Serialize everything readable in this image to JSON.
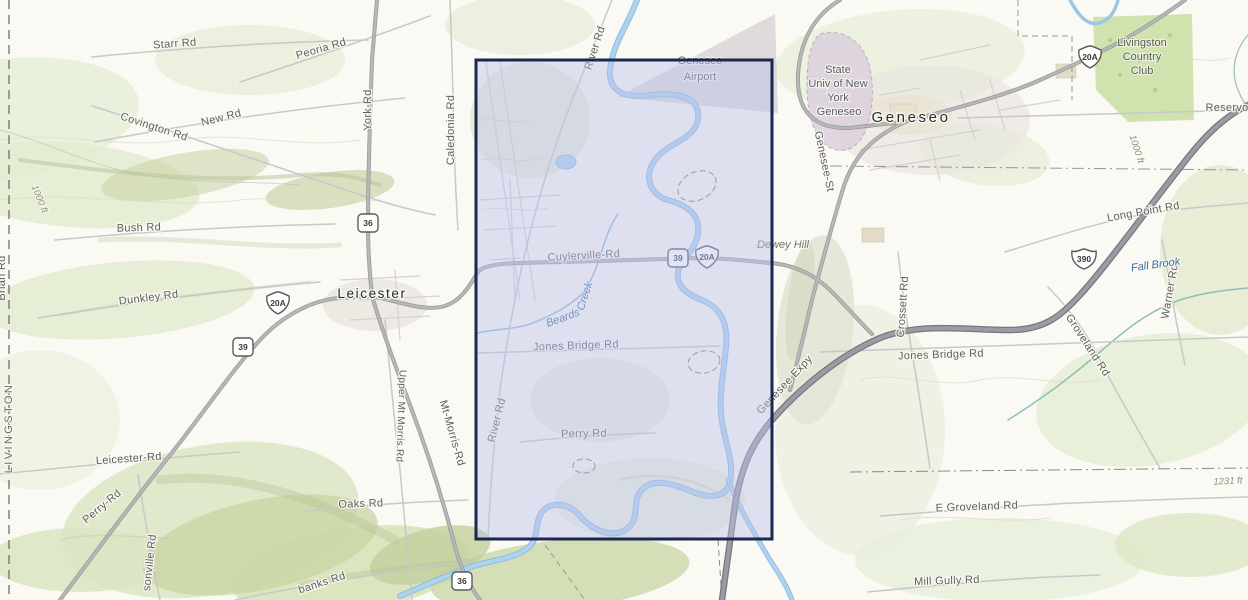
{
  "map": {
    "selection": {
      "x": 476,
      "y": 60,
      "width": 296,
      "height": 479
    },
    "colors": {
      "selection_fill": "#bdc0ec",
      "selection_border": "#1a2850",
      "water": "#aed3ee",
      "water_casing": "#8fbcdf",
      "road_major": "#b5b5b5",
      "road_casing": "#999999",
      "road_minor": "#c8c8c8",
      "expressway": "#9b9ba3",
      "expressway_casing": "#77777f",
      "terrain_green": "#e7eed9",
      "golf_green": "#cde2ab",
      "campus_purple": "#dccfdd",
      "airport_gray": "#c9c2c9",
      "water_label": "#3a6ca6",
      "road_label": "#5f5f5f"
    },
    "road_labels": [
      {
        "text": "Starr Rd"
      },
      {
        "text": "Peoria Rd"
      },
      {
        "text": "New Rd"
      },
      {
        "text": "Covington Rd"
      },
      {
        "text": "York-Rd"
      },
      {
        "text": "Caledonia Rd"
      },
      {
        "text": "Bush Rd"
      },
      {
        "text": "Dunkley Rd"
      },
      {
        "text": "Brian Rd"
      },
      {
        "text": "Leicester-Rd"
      },
      {
        "text": "Perry-Rd"
      },
      {
        "text": "sonville Rd"
      },
      {
        "text": "Oaks Rd"
      },
      {
        "text": "banks Rd"
      },
      {
        "text": "Upper Mt Morris Rd"
      },
      {
        "text": "Mt-Morris-Rd"
      },
      {
        "text": "River Rd"
      },
      {
        "text": "Cuylerville-Rd"
      },
      {
        "text": "Jones Bridge Rd"
      },
      {
        "text": "River Rd"
      },
      {
        "text": "Perry Rd"
      },
      {
        "text": "Genesee-St"
      },
      {
        "text": "Genesee Expy"
      },
      {
        "text": "Crossett Rd"
      },
      {
        "text": "Jones Bridge Rd"
      },
      {
        "text": "Groveland Rd"
      },
      {
        "text": "Long Point Rd"
      },
      {
        "text": "Warner Rd"
      },
      {
        "text": "E Groveland Rd"
      },
      {
        "text": "Mill Gully Rd"
      },
      {
        "text": "Reservo"
      }
    ],
    "water_labels": [
      {
        "text": "Beards"
      },
      {
        "text": "Creek"
      },
      {
        "text": "Fall Brook"
      }
    ],
    "place_labels": [
      {
        "text": "Geneseo"
      },
      {
        "text": "Leicester"
      },
      {
        "text": "LIVINGSTON"
      },
      {
        "text": "Dewey Hill"
      }
    ],
    "area_labels": {
      "airport": [
        "Geneseo",
        "Airport"
      ],
      "university": [
        "State",
        "Univ of New",
        "York",
        "Geneseo"
      ],
      "country_club": [
        "Livingston",
        "Country",
        "Club"
      ]
    },
    "elevation_labels": [
      {
        "text": "1000 ft"
      },
      {
        "text": "1000 ft"
      },
      {
        "text": "1231 ft"
      }
    ],
    "shields": [
      {
        "type": "us",
        "text": "20A"
      },
      {
        "type": "us",
        "text": "20A"
      },
      {
        "type": "us",
        "text": "20A"
      },
      {
        "type": "ny",
        "text": "39"
      },
      {
        "type": "ny",
        "text": "39"
      },
      {
        "type": "ny",
        "text": "36"
      },
      {
        "type": "ny",
        "text": "36"
      },
      {
        "type": "interstate",
        "text": "390"
      }
    ]
  }
}
